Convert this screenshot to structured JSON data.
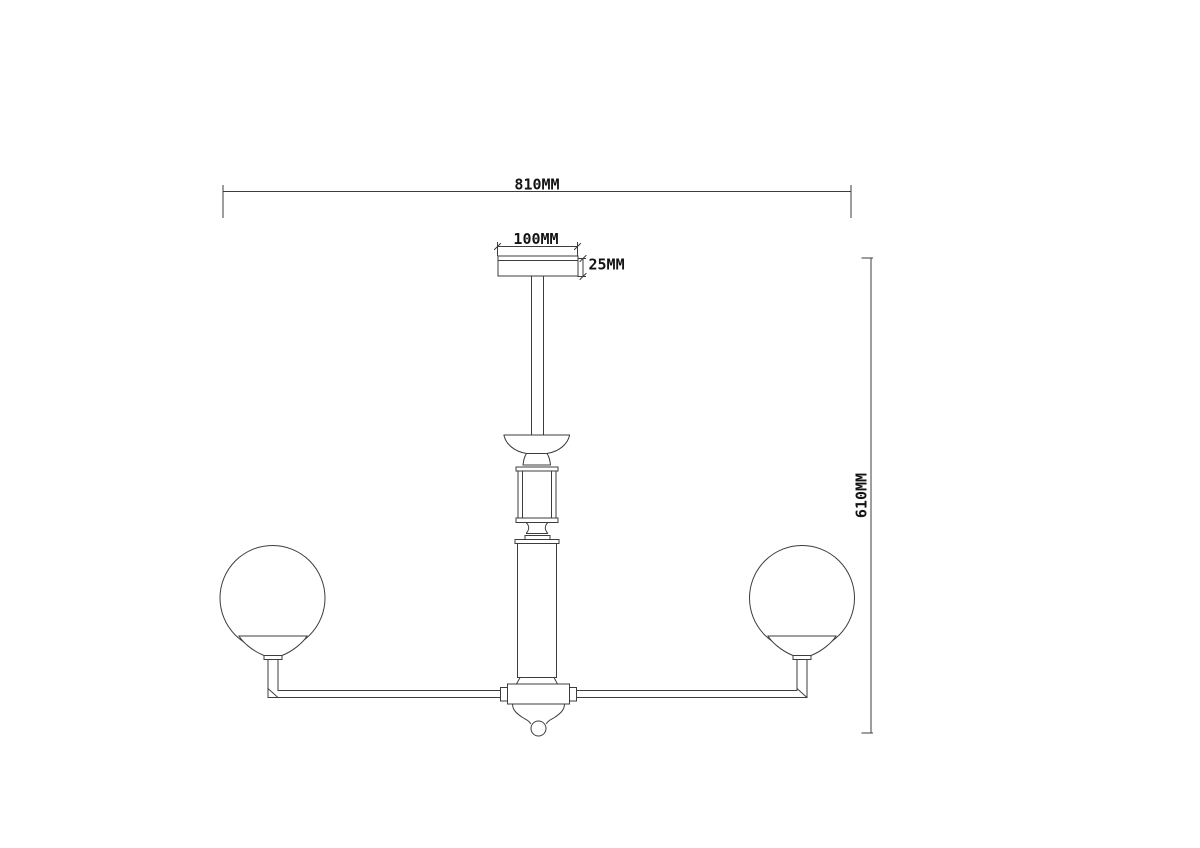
{
  "drawing": {
    "background_color": "#ffffff",
    "line_color": "#3d3d3d",
    "text_color": "#141414",
    "dims": {
      "overall_width": "810MM",
      "canopy_width": "100MM",
      "canopy_height": "25MM",
      "overall_height": "610MM"
    }
  }
}
